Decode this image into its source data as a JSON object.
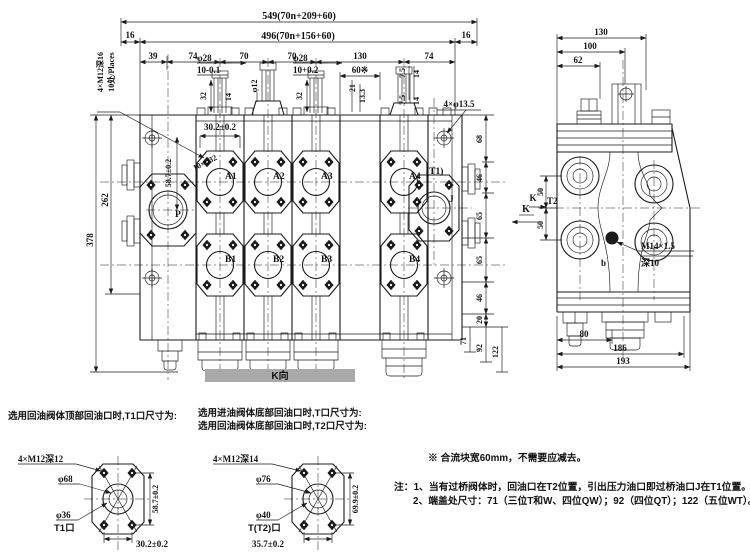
{
  "colors": {
    "line": "#1b1b1b",
    "bar": "#a9a9a9"
  },
  "mv": {
    "d549": "549(70n+209+60)",
    "d496": "496(70n+156+60)",
    "d16l": "16",
    "d16r": "16",
    "c39": "39",
    "c74a": "74",
    "c70a": "70",
    "c70b": "70",
    "c130": "130",
    "c74b": "74",
    "m12": "4×M12深16",
    "places": "10处/Places",
    "phi28a": "φ28",
    "tol10a": "10-0.1",
    "d32a": "32",
    "phi12": "φ12",
    "d14s2": "14",
    "phi28b": "φ28",
    "tol10b": "10+0.2",
    "d32b": "32",
    "d60": "60※",
    "d21": "21",
    "d133": "13.3",
    "d75a": "7.5",
    "d14a": "14",
    "d75b": "7.5",
    "d14b": "14",
    "phi135": "4×φ13.5",
    "d302": "30.2±0.2",
    "d587": "58.7±0.2",
    "bore": "10×φ32",
    "a1": "A1",
    "a2": "A2",
    "a3": "A3",
    "a4": "A4",
    "b1": "B1",
    "b2": "B2",
    "b3": "B3",
    "b4": "B4",
    "p": "P",
    "t1": "(T1)",
    "j": "J",
    "d378": "378",
    "d262": "262",
    "r68": "68",
    "r46a": "46",
    "r65a": "65",
    "r65b": "65",
    "r46b": "46",
    "r20": "20",
    "e71": "71",
    "e92": "92",
    "e122": "122",
    "k": "K"
  },
  "sv": {
    "d130": "130",
    "d100": "100",
    "d62": "62",
    "d50a": "50",
    "d50b": "50",
    "t2": "T2",
    "k": "K",
    "m14": "M14×1.5",
    "depth": "深10",
    "b": "b",
    "d80": "80",
    "d186": "186",
    "d193": "193"
  },
  "kbar": "K向",
  "cap": {
    "c1": "选用回油阀体顶部回油口时,T1口尺寸为:",
    "c2": "选用进油阀体底部回油口时,T口尺寸为:",
    "c3": "选用回油阀体底部回油口时,T2口尺寸为:"
  },
  "dt1": {
    "bolts": "4×M12深12",
    "outer": "φ68",
    "inner": "φ36",
    "port": "T1口",
    "v": "58.7±0.2",
    "h": "30.2±0.2"
  },
  "dt2": {
    "bolts": "4×M12深14",
    "outer": "φ76",
    "inner": "φ40",
    "port": "T(T2)口",
    "v": "69.9±0.2",
    "h": "35.7±0.2"
  },
  "notes": {
    "star": "※ 合流块宽60mm，不需要应减去。",
    "n1": "注：1、当有过桥阀体时，回油口在T2位置，引出压力油口即过桥油口J在T1位置。",
    "n2": "2、端盖处尺寸：71（三位T和W、四位QW）；92（四位QT）；122（五位WT）。"
  }
}
